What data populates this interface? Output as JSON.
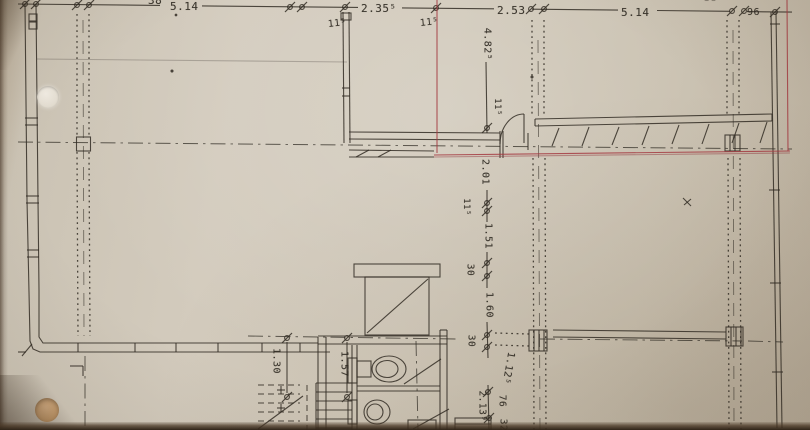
{
  "drawing": {
    "type": "scanned architectural floor plan photo",
    "marker_color": "#a43b42",
    "paper_color": "#cfc7b8",
    "ink_color": "#32362d"
  },
  "dims": {
    "top_left_cut": "38",
    "top_span_a": "5.14",
    "top_span_b": "2.35⁵",
    "top_span_c": "2.53",
    "top_span_d": "5.14",
    "top_offset_e": "96",
    "top_right_cut": "38",
    "wall_a": "11⁵",
    "wall_b": "11⁵",
    "v_a": "4.82⁵",
    "v_b": "11⁵",
    "v_c": "2.01",
    "v_d": "11⁵",
    "v_e": "1.51",
    "v_f": "30",
    "v_g": "1.60",
    "v_h": "30",
    "v_i": "1.12⁵",
    "v_j": "76",
    "v_k": "2.13⁹",
    "v_l": "32",
    "wc_a": "1.30",
    "wc_b": "1.57"
  }
}
